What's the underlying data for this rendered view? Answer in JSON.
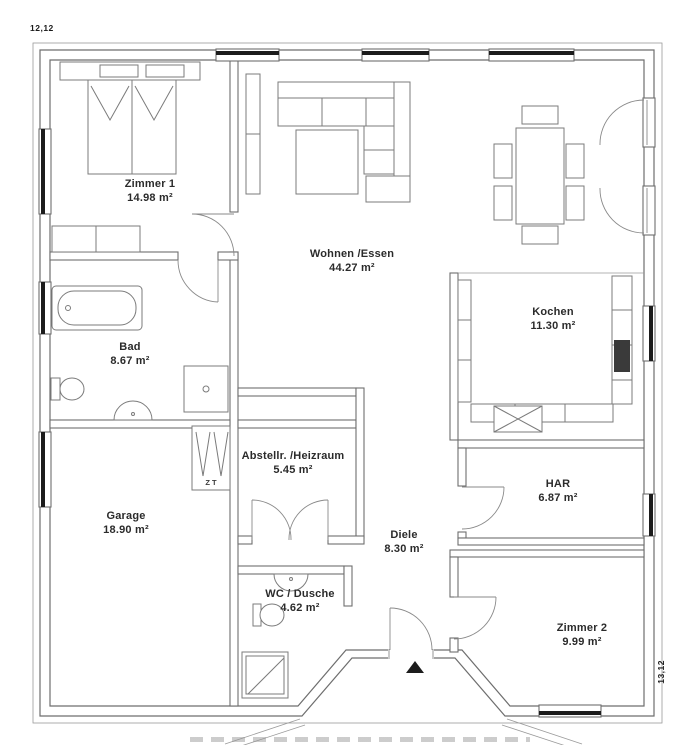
{
  "dimensions": {
    "top_left": "12,12",
    "bottom_right": "13,12"
  },
  "rooms": [
    {
      "id": "zimmer1",
      "name": "Zimmer 1",
      "area": "14.98 m²"
    },
    {
      "id": "wohnen_essen",
      "name": "Wohnen /Essen",
      "area": "44.27 m²"
    },
    {
      "id": "kochen",
      "name": "Kochen",
      "area": "11.30 m²"
    },
    {
      "id": "bad",
      "name": "Bad",
      "area": "8.67 m²"
    },
    {
      "id": "abstellraum",
      "name": "Abstellr. /Heizraum",
      "area": "5.45 m²"
    },
    {
      "id": "garage",
      "name": "Garage",
      "area": "18.90 m²"
    },
    {
      "id": "har",
      "name": "HAR",
      "area": "6.87 m²"
    },
    {
      "id": "diele",
      "name": "Diele",
      "area": "8.30 m²"
    },
    {
      "id": "wc_dusche",
      "name": "WC / Dusche",
      "area": "4.62 m²"
    },
    {
      "id": "zimmer2",
      "name": "Zimmer 2",
      "area": "9.99 m²"
    }
  ],
  "annotations": {
    "chimney": "ZT"
  },
  "colors": {
    "wall_line": "#6e6e6e",
    "furniture_line": "#7b7b7b",
    "site_line": "#9a9a9a",
    "window_bar": "#1c1c1c",
    "text": "#2b2b2b",
    "background": "#ffffff"
  }
}
